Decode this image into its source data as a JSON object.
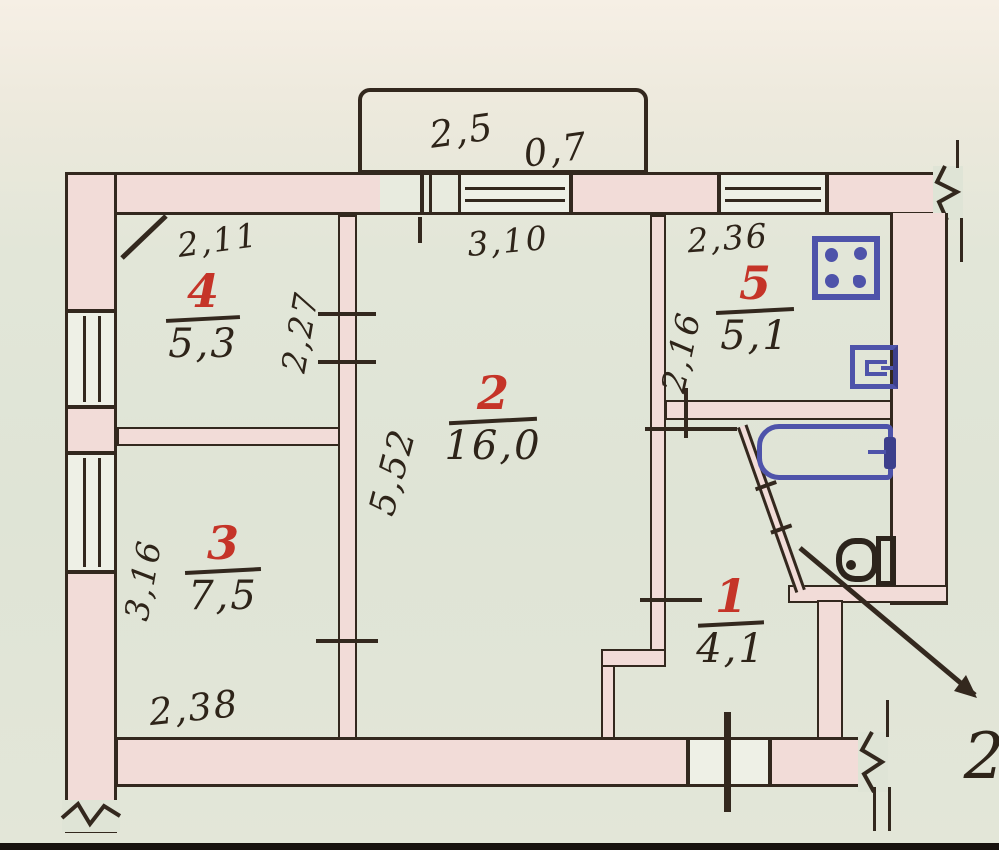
{
  "title": "Hand-drawn apartment floor plan",
  "colors": {
    "paper": "#dfe4d6",
    "wall_fill": "#f2dcd8",
    "ink": "#33281e",
    "room_number_red": "#c53428",
    "fixture_blue": "#4e53aa"
  },
  "balcony": {
    "width": "2,5",
    "depth": "0,7"
  },
  "rooms": {
    "r1": {
      "number": "1",
      "area": "4,1"
    },
    "r2": {
      "number": "2",
      "area": "16,0"
    },
    "r3": {
      "number": "3",
      "area": "7,5"
    },
    "r4": {
      "number": "4",
      "area": "5,3"
    },
    "r5": {
      "number": "5",
      "area": "5,1"
    }
  },
  "dimensions": {
    "room4_width": "2,11",
    "room2_width": "3,10",
    "kitchen_width": "2,36",
    "room4_depth": "2,27",
    "kitchen_depth": "2,16",
    "room2_depth": "5,52",
    "room3_depth": "3,16",
    "room3_width": "2,38"
  },
  "annotation": {
    "pointer_label": "2"
  },
  "fixtures": {
    "stove": "stove-icon",
    "sink": "sink-icon",
    "bathtub": "bathtub-icon",
    "toilet": "toilet-icon"
  }
}
